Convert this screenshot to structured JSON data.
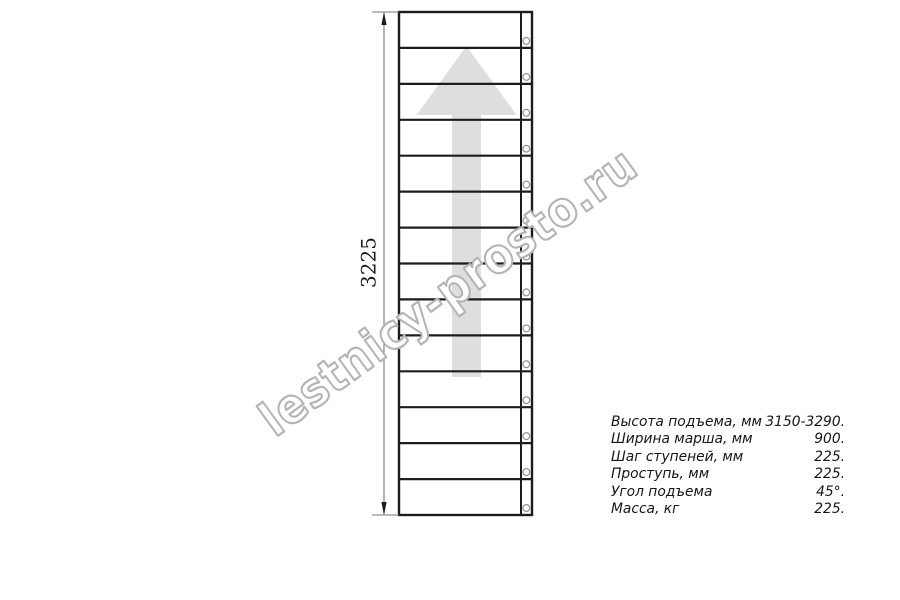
{
  "drawing": {
    "name": "straight-staircase-plan-view",
    "steps": 14,
    "fastener_circles": 14,
    "climb_direction": "up",
    "colors": {
      "line": "#1c1c1c",
      "dimension_line": "#787878",
      "arrow_watermark_fill": "#dedede",
      "circle_stroke": "#909090",
      "watermark_outline": "#b4b4b4",
      "text": "#1a1a1a",
      "background": "#ffffff"
    }
  },
  "dimension": {
    "value": "3225"
  },
  "watermark": {
    "text": "lestnicy-prosto.ru"
  },
  "specs": {
    "rows": [
      {
        "label": "Высота подъема, мм",
        "value": "3150-3290."
      },
      {
        "label": "Ширина марша, мм",
        "value": "900."
      },
      {
        "label": "Шаг ступеней, мм",
        "value": "225."
      },
      {
        "label": "Проступь, мм",
        "value": "225."
      },
      {
        "label": "Угол подъема",
        "value": "45°."
      },
      {
        "label": "Масса, кг",
        "value": "225."
      }
    ]
  }
}
